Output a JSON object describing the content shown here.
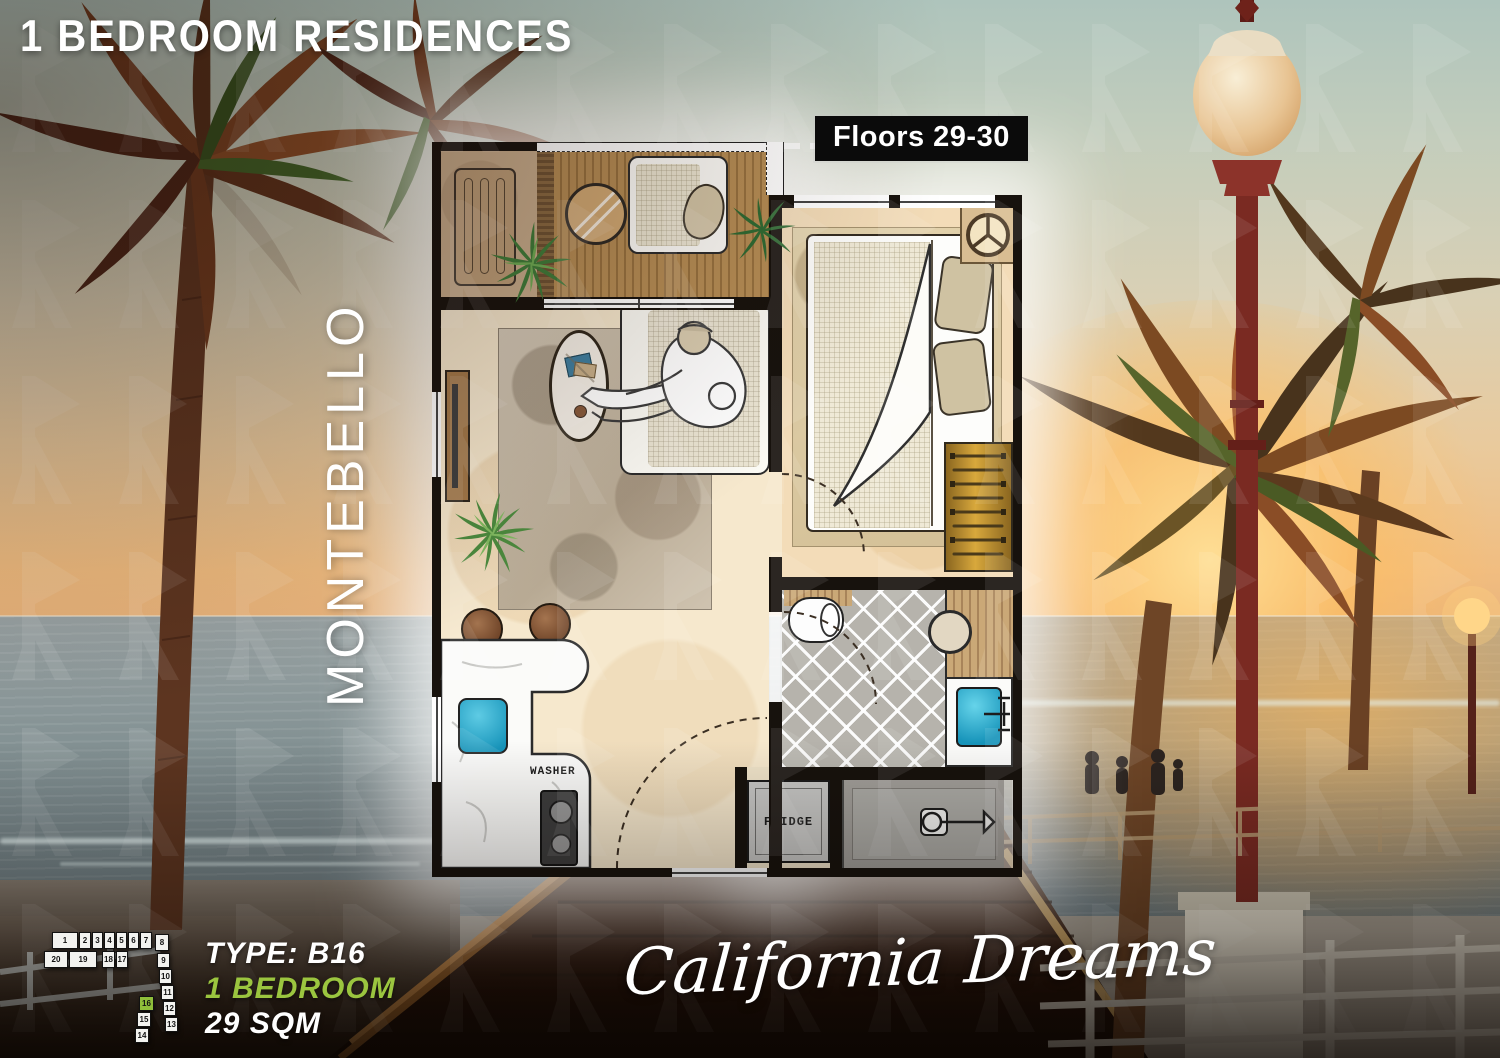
{
  "header": {
    "title": "1 BEDROOM RESIDENCES"
  },
  "floor_badge": {
    "label": "Floors 29-30"
  },
  "building": {
    "name": "MONTEBELLO"
  },
  "tagline": {
    "text": "California Dreams"
  },
  "unit_info": {
    "type": "TYPE: B16",
    "bedrooms": "1 BEDROOM",
    "area": "29 SQM"
  },
  "floorplan": {
    "washer_label": "WASHER",
    "fridge_label": "FRIDGE"
  },
  "keyplan": {
    "highlighted_unit": "16",
    "units": [
      {
        "n": "1",
        "x": 10,
        "y": 2,
        "w": 26,
        "h": 17,
        "hl": false
      },
      {
        "n": "2",
        "x": 37,
        "y": 2,
        "w": 12,
        "h": 17,
        "hl": false
      },
      {
        "n": "3",
        "x": 50,
        "y": 2,
        "w": 11,
        "h": 17,
        "hl": false
      },
      {
        "n": "4",
        "x": 62,
        "y": 2,
        "w": 11,
        "h": 17,
        "hl": false
      },
      {
        "n": "5",
        "x": 74,
        "y": 2,
        "w": 11,
        "h": 17,
        "hl": false
      },
      {
        "n": "6",
        "x": 86,
        "y": 2,
        "w": 11,
        "h": 17,
        "hl": false
      },
      {
        "n": "7",
        "x": 98,
        "y": 2,
        "w": 12,
        "h": 17,
        "hl": false
      },
      {
        "n": "8",
        "x": 113,
        "y": 4,
        "w": 14,
        "h": 17,
        "hl": false
      },
      {
        "n": "20",
        "x": 2,
        "y": 21,
        "w": 24,
        "h": 17,
        "hl": false
      },
      {
        "n": "19",
        "x": 27,
        "y": 21,
        "w": 28,
        "h": 17,
        "hl": false
      },
      {
        "n": "18",
        "x": 60,
        "y": 21,
        "w": 13,
        "h": 17,
        "hl": false
      },
      {
        "n": "17",
        "x": 74,
        "y": 21,
        "w": 12,
        "h": 17,
        "hl": false
      },
      {
        "n": "9",
        "x": 115,
        "y": 23,
        "w": 13,
        "h": 15,
        "hl": false
      },
      {
        "n": "10",
        "x": 117,
        "y": 39,
        "w": 13,
        "h": 15,
        "hl": false
      },
      {
        "n": "11",
        "x": 119,
        "y": 55,
        "w": 13,
        "h": 15,
        "hl": false
      },
      {
        "n": "12",
        "x": 121,
        "y": 71,
        "w": 13,
        "h": 15,
        "hl": false
      },
      {
        "n": "13",
        "x": 123,
        "y": 87,
        "w": 13,
        "h": 15,
        "hl": false
      },
      {
        "n": "16",
        "x": 97,
        "y": 66,
        "w": 15,
        "h": 15,
        "hl": true
      },
      {
        "n": "15",
        "x": 95,
        "y": 82,
        "w": 14,
        "h": 15,
        "hl": false
      },
      {
        "n": "14",
        "x": 93,
        "y": 98,
        "w": 14,
        "h": 15,
        "hl": false
      }
    ]
  },
  "colors": {
    "accent_green": "#9bc53f",
    "keyplan_highlight": "#8fbf3a",
    "badge_bg": "#0b0b0b",
    "text_white": "#ffffff"
  }
}
